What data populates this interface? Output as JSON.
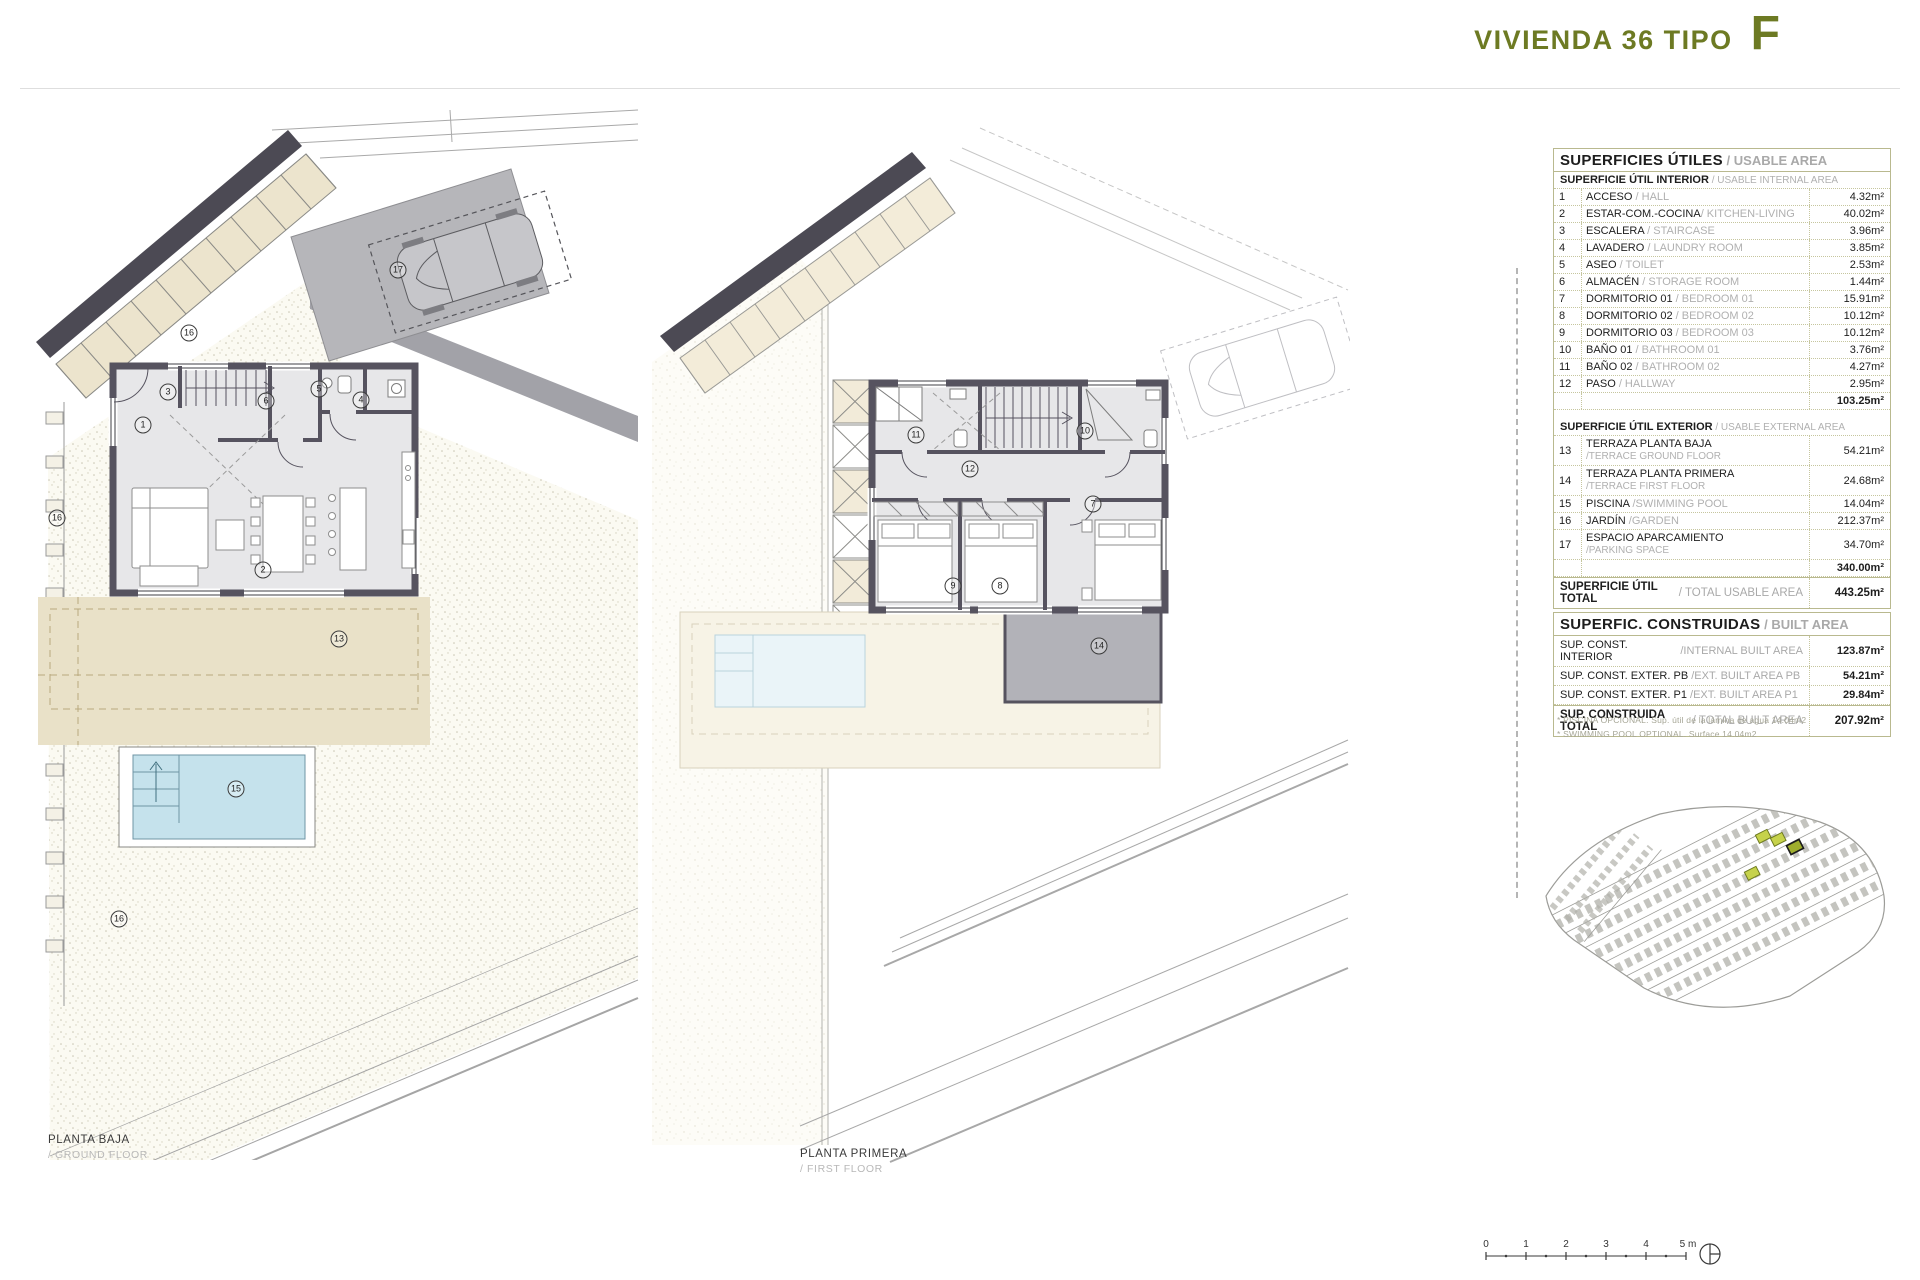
{
  "header": {
    "title": "VIVIENDA 36 TIPO",
    "type_letter": "F"
  },
  "plans": {
    "ground": {
      "label_es": "PLANTA BAJA",
      "label_en": "/ GROUND FLOOR"
    },
    "first": {
      "label_es": "PLANTA PRIMERA",
      "label_en": "/ FIRST FLOOR"
    }
  },
  "markers": {
    "r1": "1",
    "r2": "2",
    "r3": "3",
    "r4": "4",
    "r5": "5",
    "r6": "6",
    "r7": "7",
    "r8": "8",
    "r9": "9",
    "r10": "10",
    "r11": "11",
    "r12": "12",
    "r13": "13",
    "r14": "14",
    "r15": "15",
    "r16": "16",
    "r17": "17"
  },
  "usable": {
    "title_es": "SUPERFICIES ÚTILES",
    "title_en": " / USABLE AREA",
    "interior_header_es": "SUPERFICIE ÚTIL INTERIOR",
    "interior_header_en": " / USABLE INTERNAL AREA",
    "interior_rows": [
      {
        "n": "1",
        "es": "ACCESO",
        "en": " / HALL",
        "val": "4.32m²"
      },
      {
        "n": "2",
        "es": "ESTAR-COM.-COCINA",
        "en": "/ KITCHEN-LIVING",
        "val": "40.02m²"
      },
      {
        "n": "3",
        "es": "ESCALERA",
        "en": " / STAIRCASE",
        "val": "3.96m²"
      },
      {
        "n": "4",
        "es": "LAVADERO",
        "en": " / LAUNDRY ROOM",
        "val": "3.85m²"
      },
      {
        "n": "5",
        "es": "ASEO",
        "en": " / TOILET",
        "val": "2.53m²"
      },
      {
        "n": "6",
        "es": "ALMACÉN",
        "en": " / STORAGE ROOM",
        "val": "1.44m²"
      },
      {
        "n": "7",
        "es": "DORMITORIO 01",
        "en": " / BEDROOM 01",
        "val": "15.91m²"
      },
      {
        "n": "8",
        "es": "DORMITORIO 02",
        "en": " / BEDROOM 02",
        "val": "10.12m²"
      },
      {
        "n": "9",
        "es": "DORMITORIO 03",
        "en": " / BEDROOM 03",
        "val": "10.12m²"
      },
      {
        "n": "10",
        "es": "BAÑO 01",
        "en": " / BATHROOM 01",
        "val": "3.76m²"
      },
      {
        "n": "11",
        "es": "BAÑO 02",
        "en": " / BATHROOM 02",
        "val": "4.27m²"
      },
      {
        "n": "12",
        "es": "PASO",
        "en": " / HALLWAY",
        "val": "2.95m²"
      }
    ],
    "interior_subtotal": "103.25m²",
    "exterior_header_es": "SUPERFICIE ÚTIL EXTERIOR",
    "exterior_header_en": " / USABLE EXTERNAL AREA",
    "exterior_rows": [
      {
        "n": "13",
        "es": "TERRAZA PLANTA BAJA",
        "en2": "/TERRACE GROUND FLOOR",
        "val": "54.21m²"
      },
      {
        "n": "14",
        "es": "TERRAZA PLANTA PRIMERA",
        "en2": "/TERRACE FIRST FLOOR",
        "val": "24.68m²"
      },
      {
        "n": "15",
        "es": "PISCINA",
        "en": " /SWIMMING POOL",
        "val": "14.04m²"
      },
      {
        "n": "16",
        "es": "JARDÍN",
        "en": " /GARDEN",
        "val": "212.37m²"
      },
      {
        "n": "17",
        "es": "ESPACIO APARCAMIENTO",
        "en2": "/PARKING SPACE",
        "val": "34.70m²"
      }
    ],
    "exterior_subtotal": "340.00m²",
    "total_es": "SUPERFICIE ÚTIL TOTAL",
    "total_en": " / TOTAL USABLE AREA",
    "total_val": "443.25m²"
  },
  "built": {
    "title_es": "SUPERFIC. CONSTRUIDAS",
    "title_en": " / BUILT AREA",
    "rows": [
      {
        "es": "SUP. CONST. INTERIOR",
        "en": "/INTERNAL BUILT AREA",
        "val": "123.87m²"
      },
      {
        "es": "SUP. CONST. EXTER. PB",
        "en": " /EXT. BUILT AREA PB",
        "val": "54.21m²"
      },
      {
        "es": "SUP. CONST. EXTER. P1",
        "en": " /EXT. BUILT AREA P1",
        "val": "29.84m²"
      }
    ],
    "total_es": "SUP. CONSTRUIDA TOTAL",
    "total_en": " / TOTAL BUILT AREA",
    "total_val": "207.92m²",
    "footnote_es": "* PISCINA OPCIONAL. Sup. útil de la lámina de agua 14.04m2",
    "footnote_en": "* SWIMMING POOL OPTIONAL. Surface 14.04m2"
  },
  "scalebar": {
    "ticks": [
      "0",
      "1",
      "2",
      "3",
      "4",
      "5 m"
    ]
  },
  "colors": {
    "accent_green": "#6d7a23",
    "table_border": "#b9b98f",
    "wall": "#56535f",
    "parking_gray": "#b6b6ba",
    "terrace_beige": "#e9e1c8",
    "pool_blue": "#c5e2ec",
    "road_band": "#4c4a54",
    "minimap_highlight": "#c6d24b",
    "minimap_selected": "#9fae2e"
  }
}
